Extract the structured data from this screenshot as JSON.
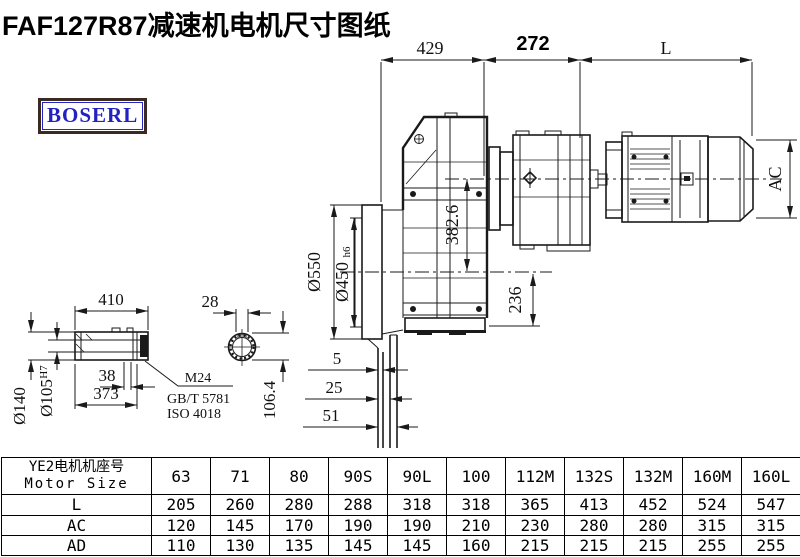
{
  "title": "FAF127R87减速机电机尺寸图纸",
  "logo": {
    "text": "BOSERL",
    "text_color": "#2222c0",
    "border_color": "#3b2a24"
  },
  "drawing": {
    "line_color": "#1a1a1a",
    "top_dims": {
      "d429": "429",
      "d272": "272",
      "dL": "L"
    },
    "right_dims": {
      "ac": "AC"
    },
    "main_dims": {
      "dia550": "Ø550",
      "dia450": "Ø450",
      "h6": "h6",
      "d382": "382.6",
      "d236": "236",
      "d5": "5",
      "d25": "25",
      "d51": "51"
    },
    "shaft_dims": {
      "d410": "410",
      "d28": "28",
      "dia140": "Ø140",
      "dia105": "Ø105",
      "h7": "H7",
      "d38": "38",
      "d373": "373",
      "d106": "106.4"
    },
    "callouts": {
      "m24": "M24",
      "gbt": "GB/T 5781",
      "iso": "ISO 4018"
    }
  },
  "table": {
    "header_cn": "YE2电机机座号",
    "header_en": "Motor Size",
    "columns": [
      "63",
      "71",
      "80",
      "90S",
      "90L",
      "100",
      "112M",
      "132S",
      "132M",
      "160M",
      "160L"
    ],
    "rows": [
      {
        "label": "L",
        "values": [
          "205",
          "260",
          "280",
          "288",
          "318",
          "318",
          "365",
          "413",
          "452",
          "524",
          "547"
        ]
      },
      {
        "label": "AC",
        "values": [
          "120",
          "145",
          "170",
          "190",
          "190",
          "210",
          "230",
          "280",
          "280",
          "315",
          "315"
        ]
      },
      {
        "label": "AD",
        "values": [
          "110",
          "130",
          "135",
          "145",
          "145",
          "160",
          "215",
          "215",
          "215",
          "255",
          "255"
        ]
      }
    ]
  }
}
